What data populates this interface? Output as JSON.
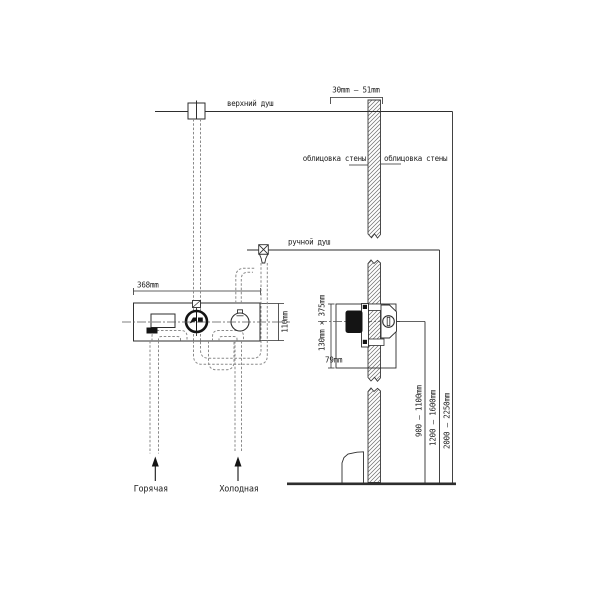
{
  "diagram": {
    "labels": {
      "overhead_shower": "верхний душ",
      "hand_shower": "ручной душ",
      "wall_cladding_left": "облицовка стены",
      "wall_cladding_right": "облицовка стены",
      "hot_supply": "Горячая",
      "cold_supply": "Холодная"
    },
    "dimensions": {
      "cladding_thickness": "30mm — 51mm",
      "plate_width": "368mm",
      "plate_height": "110mm",
      "recess_size": "130mm × 375mm",
      "recess_depth": "79mm",
      "mixer_height": "900 — 1100mm",
      "hand_shower_height": "1200 — 1600mm",
      "overhead_shower_height": "2000 — 2250mm"
    },
    "colors": {
      "line": "#2e2e2e",
      "hatch": "#6b6b6b",
      "hidden_pipe": "#8a8a8a",
      "dark_fill": "#141414",
      "background": "#ffffff"
    }
  }
}
